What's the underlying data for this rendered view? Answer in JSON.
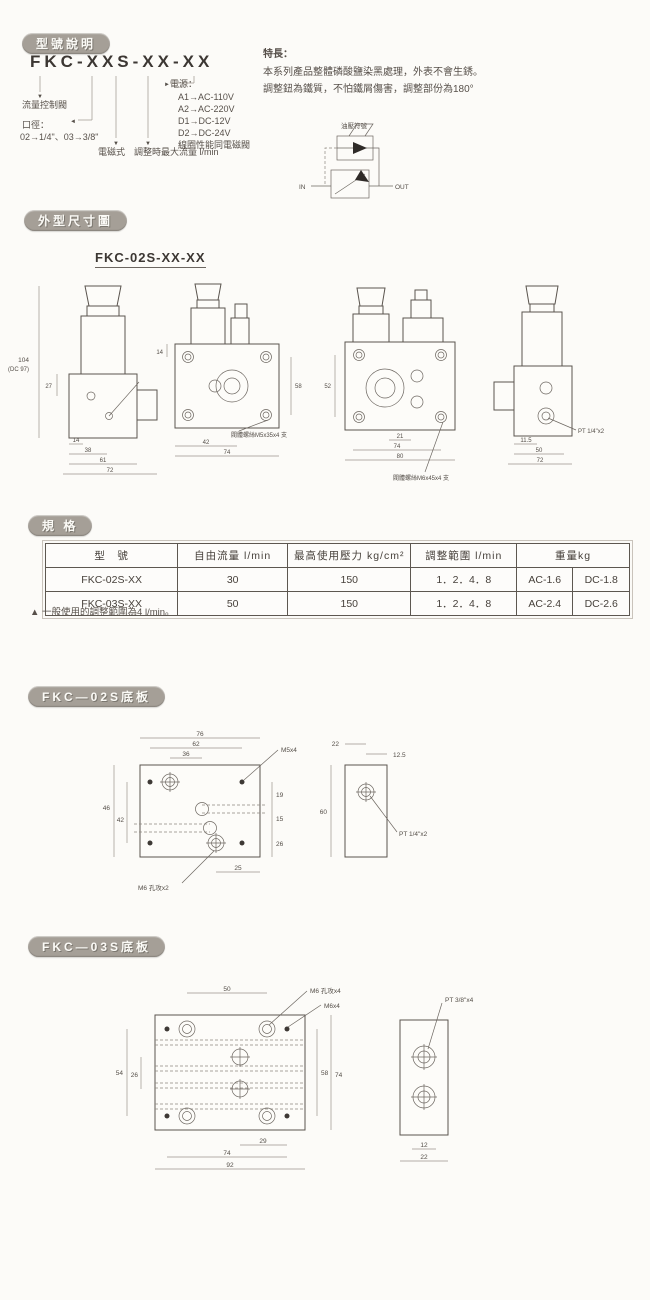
{
  "badges": {
    "model": "型號說明",
    "outline": "外型尺寸圖",
    "spec": "規 格",
    "plate02": "FKC—02S底板",
    "plate03": "FKC—03S底板"
  },
  "icons": {
    "down_arrow": "▼",
    "left_arrow": "◄",
    "right_arrow": "►"
  },
  "model": {
    "code": "FKC-XXS-XX-XX",
    "flow_label": "流量控制閥",
    "bore_label": "口徑：",
    "bore_options": "02→1/4\"、03→3/8\"",
    "solenoid_label": "電磁式",
    "flowmax_label": "調整時最大流量 l/min",
    "power_label": "電源：",
    "power_options": [
      "A1→AC-110V",
      "A2→AC-220V",
      "D1→DC-12V",
      "D2→DC-24V",
      "線圈性能同電磁閥"
    ]
  },
  "features": {
    "title": "特長：",
    "line1": "本系列產品整體磷酸鹽染黑處理，外表不會生銹。",
    "line2": "調整鈕為鐵質，不怕鐵屑傷害，調整部份為180°"
  },
  "symbol": {
    "label": "油壓符號",
    "in": "IN",
    "out": "OUT"
  },
  "outline": {
    "subtitle": "FKC-02S-XX-XX",
    "v1": {
      "d1": "104",
      "d2": "(DC 97)",
      "d3": "27",
      "d4": "14",
      "d5": "38",
      "d6": "61",
      "d7": "72"
    },
    "v2": {
      "d1": "14",
      "d2": "42",
      "d3": "74",
      "d4": "58",
      "note": "閥體螺絲M5x35x4 支"
    },
    "v3": {
      "d1": "52",
      "d2": "21",
      "d3": "74",
      "d4": "80",
      "note": "閥體螺絲M6x45x4 支"
    },
    "v4": {
      "d1": "11.5",
      "d2": "50",
      "d3": "72",
      "port": "PT 1/4\"x2"
    }
  },
  "spec": {
    "headers": [
      "型　號",
      "自由流量 l/min",
      "最高使用壓力 kg/cm²",
      "調整範圍 l/min",
      "重量kg"
    ],
    "rows": [
      {
        "model": "FKC-02S-XX",
        "flow": "30",
        "pressure": "150",
        "range": "1．2．4．8",
        "ac": "AC-1.6",
        "dc": "DC-1.8"
      },
      {
        "model": "FKC-03S-XX",
        "flow": "50",
        "pressure": "150",
        "range": "1．2．4．8",
        "ac": "AC-2.4",
        "dc": "DC-2.6"
      }
    ],
    "footnote": "▲ 一般使用的調整範圍為4 l/min。"
  },
  "plate02": {
    "top1": "76",
    "top2": "62",
    "top3": "36",
    "left1": "46",
    "left2": "42",
    "right1": "19",
    "right2": "15",
    "right3": "26",
    "bottom1": "25",
    "holes": "M5x4",
    "tap": "M6 孔攻x2",
    "side_top": "22",
    "side_offset": "12.5",
    "side_h": "60",
    "port": "PT 1/4\"x2"
  },
  "plate03": {
    "top1": "50",
    "tap": "M6 孔攻x4",
    "holes": "M6x4",
    "port": "PT 3/8\"x4",
    "left1": "54",
    "left2": "26",
    "right1": "58",
    "right2": "74",
    "bottom1": "29",
    "bottom2": "74",
    "bottom3": "92",
    "side1": "12",
    "side2": "22"
  }
}
